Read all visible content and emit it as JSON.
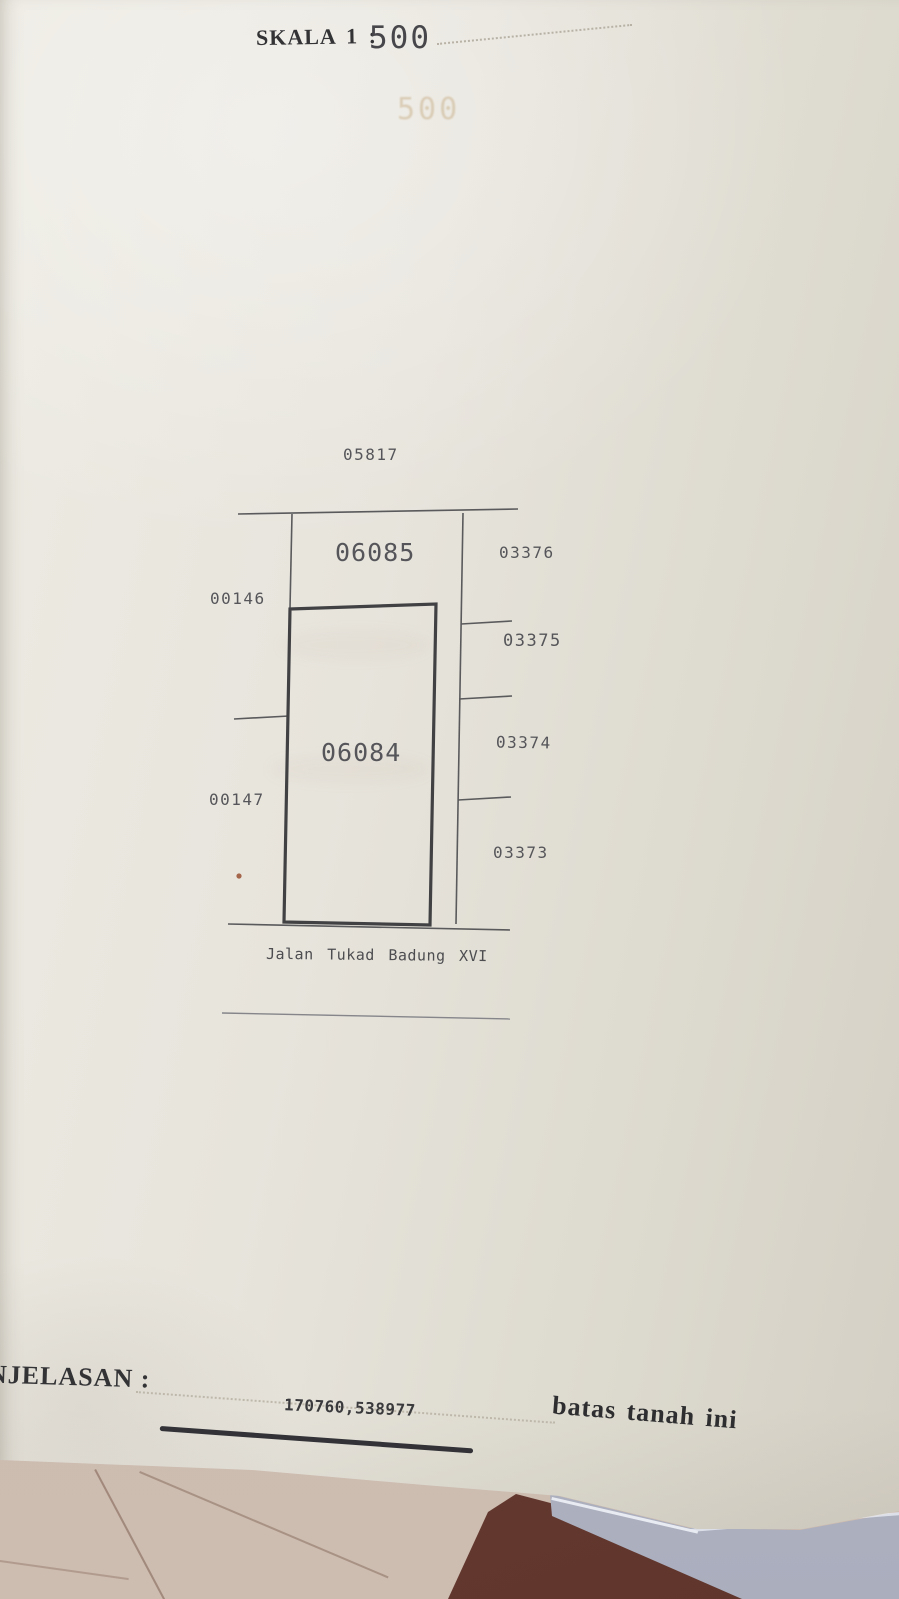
{
  "colors": {
    "paper": "#e7e4dc",
    "paper-dark": "#d4cfc4",
    "ink": "#333336",
    "plot-ink": "#56565a",
    "floor": "#c9b6a9",
    "floor-line": "#7d5f50",
    "shadow-wedge": "#5f352c",
    "under-page": "#b4b8c7",
    "under-page-edge": "#e9ebf2",
    "red-dot": "#a4654a",
    "bleed": "rgba(186,156,104,0.38)"
  },
  "header": {
    "scale_label": "SKALA 1 :",
    "scale_value": "500",
    "bleedthrough_text": "500"
  },
  "diagram": {
    "parcels": {
      "north": "05817",
      "upper_block": "06085",
      "main_block": "06084",
      "west_upper": "00146",
      "west_lower": "00147",
      "east_1": "03376",
      "east_2": "03375",
      "east_3": "03374",
      "east_4": "03373"
    },
    "street_label": "Jalan Tukad Badung XVI"
  },
  "footer": {
    "explanation_label": "NJELASAN :",
    "coordinate_value": "170760,538977",
    "boundary_note": "batas tanah ini"
  }
}
